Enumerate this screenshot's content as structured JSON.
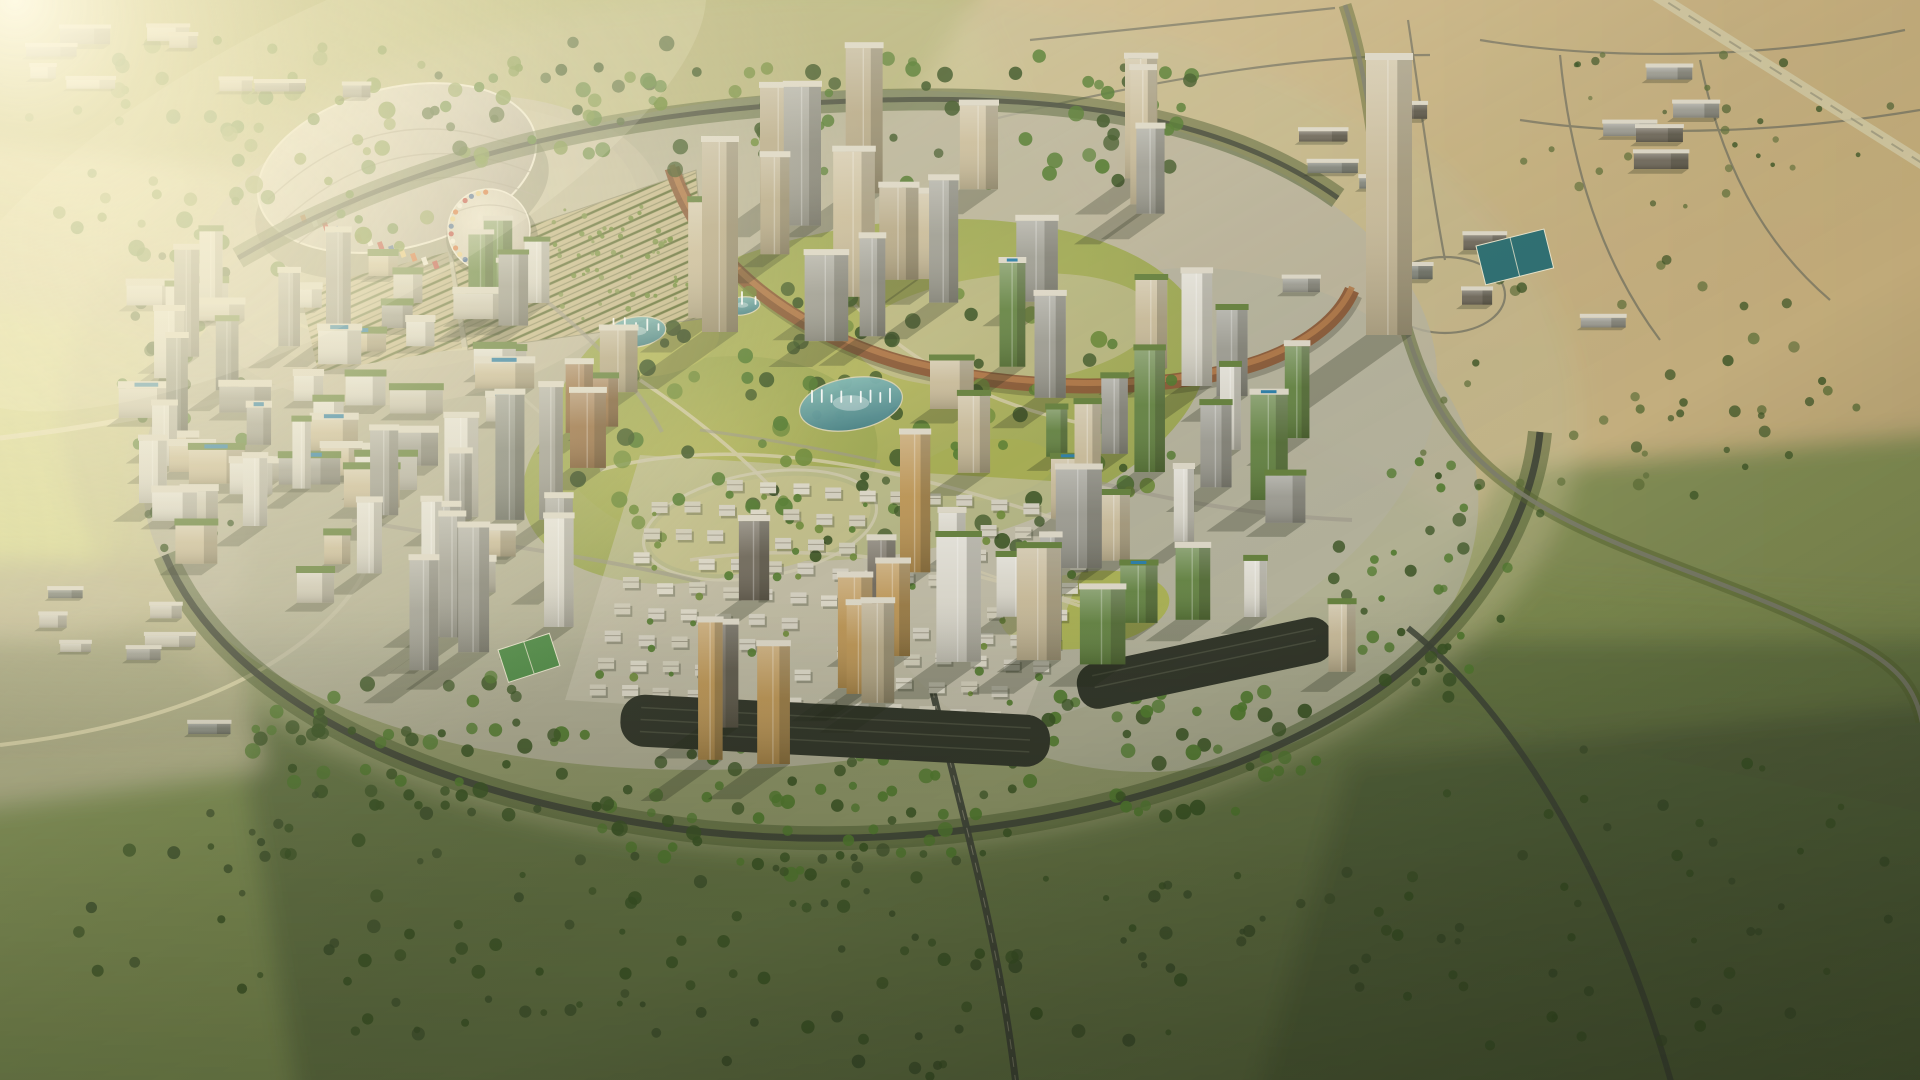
{
  "scene": {
    "title": "Aerial golden-hour render of a circular master-planned city surrounded by desert and scrubland",
    "style": "photorealistic CGI aerial perspective",
    "time_of_day": "golden hour",
    "camera": "high oblique bird's-eye view"
  },
  "regions": [
    {
      "name": "exhibition-arena",
      "desc": "fan-roofed arena with colorful mosaic drum and tree-lined parking rows"
    },
    {
      "name": "central-park",
      "desc": "large landscaped park with lawns, fountain lakes and winding paths"
    },
    {
      "name": "crescent-viaduct",
      "desc": "curved bronze transit viaduct sweeping through the northern tower district"
    },
    {
      "name": "villa-district",
      "desc": "diagonal grid of low-rise white courtyard villas among trees"
    },
    {
      "name": "tower-districts",
      "desc": "clusters of high-rise towers with rooftop gardens, pools and vertical greenery"
    },
    {
      "name": "ring-road",
      "desc": "tree-lined ring road encircling the development"
    },
    {
      "name": "desert-outskirts",
      "desc": "sandy plots, suburban road grids and scrub beyond the site"
    }
  ],
  "palette": {
    "sand": "#c9b488",
    "fieldPale": "#d6d1a2",
    "olive": "#76854c",
    "scrubDark": "#465430",
    "treeDark": "#3c5526",
    "treeMid": "#527a30",
    "treeOlive": "#6d8a3a",
    "parkLawn": "#a0aa52",
    "roadDark": "#41463a",
    "water": "#58959c",
    "pool": "#2e7fa8",
    "crescent": "#8a5a38",
    "stadiumRoof": "#c3bcae",
    "towerTan": "#b3a583",
    "towerBeige": "#c6b896",
    "towerWhite": "#d9d6ca",
    "towerGray": "#9a998f",
    "towerSlate": "#7f8278",
    "towerGold": "#b9914f",
    "towerDark": "#6b6456",
    "towerBronze": "#92693d",
    "greenFacade": "#5f7f3d",
    "greenRoof": "#66813f",
    "plaza": "#c9c4b2",
    "flare": "#fff6dc"
  },
  "stadium": {
    "roof": {
      "cx": 397,
      "cy": 168,
      "rx": 142,
      "ry": 80,
      "rotate": -14
    },
    "dome": {
      "cx": 489,
      "cy": 230,
      "r": 41
    },
    "mosaic_colors": [
      "#d4622a",
      "#f2ede0",
      "#b83330",
      "#3a5f94",
      "#e8c87a"
    ],
    "facade_strip": {
      "x1": 300,
      "y1": 216,
      "x2": 432,
      "y2": 262,
      "n": 13
    }
  },
  "lakes": [
    {
      "cx": 851,
      "cy": 404,
      "rx": 52,
      "ry": 26,
      "rot": -10,
      "jets": 9
    },
    {
      "cx": 636,
      "cy": 332,
      "rx": 30,
      "ry": 15,
      "rot": -8,
      "jets": 5
    },
    {
      "cx": 742,
      "cy": 306,
      "rx": 18,
      "ry": 9,
      "rot": -8,
      "jets": 3
    }
  ],
  "courts": [
    {
      "x": 498,
      "y": 650,
      "w": 54,
      "h": 34,
      "rot": -18,
      "color": "#4e8a46"
    },
    {
      "x": 1476,
      "y": 246,
      "w": 70,
      "h": 40,
      "rot": -14,
      "color": "#2e6f72"
    }
  ],
  "villa_district": {
    "origin": [
      660,
      475
    ],
    "cols": 14,
    "rows": 9,
    "col_step": [
      33,
      2.4
    ],
    "row_step": [
      -9,
      26
    ],
    "w": 16,
    "h": 11,
    "skip": 0.13,
    "tree": 0.5,
    "colors": [
      "#dbd7c7",
      "#cfcbb8",
      "#d3cfc0"
    ],
    "seed": 7
  },
  "landmarks": [
    {
      "name": "signature-tower",
      "x": 1366,
      "y": 335,
      "w": 46,
      "f": 275,
      "roof": 7,
      "color": "towerBeige"
    },
    {
      "name": "twin-gateway-tower",
      "x": 702,
      "y": 332,
      "w": 36,
      "f": 190,
      "roof": 6,
      "color": "towerTan"
    }
  ],
  "clusters": [
    {
      "name": "left-midrise-district",
      "cx": 330,
      "cy": 440,
      "sx": 185,
      "sy": 165,
      "count": 42,
      "wMin": 24,
      "wMax": 62,
      "fMin": 16,
      "fMax": 40,
      "roof": 7,
      "colors": [
        "towerWhite",
        "towerGray",
        "plaza",
        "towerBeige"
      ],
      "green": 0.4,
      "pool": 0.14,
      "seed": 11
    },
    {
      "name": "left-highrise",
      "cx": 260,
      "cy": 420,
      "sx": 120,
      "sy": 140,
      "count": 12,
      "wMin": 18,
      "wMax": 34,
      "fMin": 60,
      "fMax": 125,
      "roof": 6,
      "colors": [
        "towerWhite",
        "towerGray",
        "towerSlate"
      ],
      "green": 0.25,
      "pool": 0.1,
      "seed": 22
    },
    {
      "name": "gateway-towers",
      "cx": 505,
      "cy": 285,
      "sx": 45,
      "sy": 70,
      "count": 5,
      "wMin": 18,
      "wMax": 30,
      "fMin": 55,
      "fMax": 105,
      "roof": 5,
      "colors": [
        "towerWhite",
        "greenFacade",
        "towerGray"
      ],
      "green": 0.4,
      "pool": 0,
      "seed": 33
    },
    {
      "name": "crescent-highrise",
      "cx": 965,
      "cy": 262,
      "sx": 265,
      "sy": 85,
      "count": 16,
      "wMin": 24,
      "wMax": 44,
      "fMin": 70,
      "fMax": 150,
      "roof": 6,
      "colors": [
        "towerTan",
        "towerBeige",
        "towerGray"
      ],
      "green": 0.15,
      "pool": 0,
      "seed": 44
    },
    {
      "name": "park-edge-bronze",
      "cx": 592,
      "cy": 432,
      "sx": 38,
      "sy": 48,
      "count": 4,
      "wMin": 26,
      "wMax": 40,
      "fMin": 45,
      "fMax": 85,
      "roof": 6,
      "colors": [
        "towerBronze",
        "towerTan"
      ],
      "green": 0.2,
      "pool": 0,
      "seed": 55
    },
    {
      "name": "east-garden-towers",
      "cx": 1165,
      "cy": 540,
      "sx": 215,
      "sy": 175,
      "count": 30,
      "wMin": 20,
      "wMax": 46,
      "fMin": 45,
      "fMax": 125,
      "roof": 6,
      "colors": [
        "towerWhite",
        "towerBeige",
        "greenFacade",
        "towerGray"
      ],
      "green": 0.55,
      "pool": 0.12,
      "seed": 66
    },
    {
      "name": "south-highrise",
      "cx": 480,
      "cy": 622,
      "sx": 125,
      "sy": 115,
      "count": 13,
      "wMin": 20,
      "wMax": 40,
      "fMin": 60,
      "fMax": 140,
      "roof": 6,
      "colors": [
        "towerWhite",
        "towerGray",
        "towerSlate"
      ],
      "green": 0.15,
      "pool": 0,
      "seed": 77
    },
    {
      "name": "south-gold-towers",
      "cx": 790,
      "cy": 662,
      "sx": 130,
      "sy": 110,
      "count": 10,
      "wMin": 24,
      "wMax": 46,
      "fMin": 70,
      "fMax": 150,
      "roof": 6,
      "colors": [
        "towerGold",
        "towerTan",
        "towerDark"
      ],
      "green": 0.1,
      "pool": 0,
      "seed": 88
    },
    {
      "name": "desert-compounds",
      "cx": 1530,
      "cy": 200,
      "sx": 250,
      "sy": 130,
      "count": 14,
      "wMin": 22,
      "wMax": 64,
      "fMin": 7,
      "fMax": 16,
      "roof": 4,
      "colors": [
        "towerSlate",
        "towerDark",
        "towerGray"
      ],
      "green": 0,
      "pool": 0,
      "seed": 99
    },
    {
      "name": "north-industrial",
      "cx": 190,
      "cy": 70,
      "sx": 170,
      "sy": 45,
      "count": 9,
      "wMin": 24,
      "wMax": 60,
      "fMin": 8,
      "fMax": 16,
      "roof": 4,
      "colors": [
        "towerWhite",
        "plaza",
        "towerGray"
      ],
      "green": 0,
      "pool": 0,
      "seed": 111
    },
    {
      "name": "west-industrial",
      "cx": 130,
      "cy": 660,
      "sx": 95,
      "sy": 75,
      "count": 7,
      "wMin": 26,
      "wMax": 58,
      "fMin": 8,
      "fMax": 14,
      "roof": 4,
      "colors": [
        "towerGray",
        "towerSlate",
        "plaza"
      ],
      "green": 0,
      "pool": 0,
      "seed": 122
    }
  ],
  "tree_regions": [
    {
      "name": "northwest-forest",
      "cx": 260,
      "cy": 150,
      "rx": 250,
      "ry": 120,
      "count": 70,
      "rMin": 4,
      "rMax": 9,
      "colors": [
        "treeOlive",
        "treeMid",
        "#7d934a"
      ],
      "seed": 1
    },
    {
      "name": "stadium-grove",
      "cx": 610,
      "cy": 110,
      "rx": 200,
      "ry": 75,
      "count": 55,
      "rMin": 4,
      "rMax": 8,
      "colors": [
        "treeMid",
        "treeDark",
        "treeOlive"
      ],
      "seed": 2
    },
    {
      "name": "north-belt",
      "cx": 1000,
      "cy": 120,
      "rx": 260,
      "ry": 70,
      "count": 55,
      "rMin": 4,
      "rMax": 8,
      "colors": [
        "treeMid",
        "treeDark"
      ],
      "seed": 3
    },
    {
      "name": "park-canopy",
      "cx": 870,
      "cy": 430,
      "rx": 320,
      "ry": 150,
      "count": 120,
      "rMin": 4,
      "rMax": 9,
      "colors": [
        "treeMid",
        "treeOlive",
        "treeDark"
      ],
      "seed": 4
    },
    {
      "name": "ring-belt-west",
      "cx": 185,
      "cy": 395,
      "rx": 70,
      "ry": 170,
      "count": 45,
      "rMin": 3,
      "rMax": 7,
      "colors": [
        "treeMid",
        "treeDark"
      ],
      "seed": 5
    },
    {
      "name": "ring-belt-south-1",
      "cx": 420,
      "cy": 740,
      "rx": 170,
      "ry": 70,
      "count": 55,
      "rMin": 4,
      "rMax": 8,
      "colors": [
        "treeDark",
        "treeMid"
      ],
      "seed": 6
    },
    {
      "name": "ring-belt-south-2",
      "cx": 800,
      "cy": 810,
      "rx": 230,
      "ry": 65,
      "count": 65,
      "rMin": 4,
      "rMax": 8,
      "colors": [
        "treeDark",
        "treeMid"
      ],
      "seed": 8
    },
    {
      "name": "ring-belt-south-3",
      "cx": 1180,
      "cy": 750,
      "rx": 190,
      "ry": 70,
      "count": 55,
      "rMin": 4,
      "rMax": 8,
      "colors": [
        "treeDark",
        "treeMid"
      ],
      "seed": 9
    },
    {
      "name": "ring-belt-east",
      "cx": 1420,
      "cy": 580,
      "rx": 90,
      "ry": 130,
      "count": 40,
      "rMin": 3,
      "rMax": 7,
      "colors": [
        "treeMid",
        "treeDark"
      ],
      "seed": 10
    },
    {
      "name": "desert-oasis",
      "cx": 1620,
      "cy": 380,
      "rx": 250,
      "ry": 150,
      "count": 45,
      "rMin": 3,
      "rMax": 6,
      "colors": [
        "treeDark",
        "#5d6e38"
      ],
      "seed": 12,
      "opacity": 0.85
    },
    {
      "name": "desert-north-scrub",
      "cx": 1700,
      "cy": 120,
      "rx": 200,
      "ry": 90,
      "count": 30,
      "rMin": 2,
      "rMax": 5,
      "colors": [
        "#5d6e38",
        "treeDark"
      ],
      "seed": 13,
      "opacity": 0.8
    },
    {
      "name": "south-scrub-east",
      "cx": 950,
      "cy": 960,
      "rx": 420,
      "ry": 120,
      "count": 80,
      "rMin": 3,
      "rMax": 7,
      "colors": [
        "treeDark",
        "#3e512c"
      ],
      "seed": 14,
      "opacity": 0.9
    },
    {
      "name": "south-scrub-west",
      "cx": 380,
      "cy": 920,
      "rx": 330,
      "ry": 130,
      "count": 60,
      "rMin": 3,
      "rMax": 7,
      "colors": [
        "#3e512c",
        "treeDark"
      ],
      "seed": 15,
      "opacity": 0.85
    },
    {
      "name": "southeast-scrub",
      "cx": 1600,
      "cy": 900,
      "rx": 300,
      "ry": 160,
      "count": 55,
      "rMin": 3,
      "rMax": 6,
      "colors": [
        "#3e512c",
        "treeDark"
      ],
      "seed": 16,
      "opacity": 0.85
    },
    {
      "name": "parking-grove",
      "cx": 608,
      "cy": 262,
      "rx": 92,
      "ry": 62,
      "count": 60,
      "rMin": 1.5,
      "rMax": 3,
      "colors": [
        "treeOlive",
        "#7d934a"
      ],
      "seed": 17
    }
  ]
}
